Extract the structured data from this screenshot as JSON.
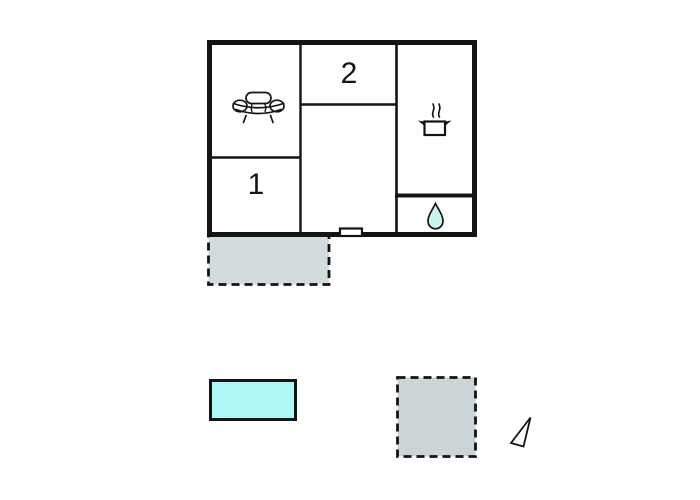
{
  "colors": {
    "ink": "#141414",
    "paper": "#ffffff",
    "terrace_fill": "#d3dbdc",
    "annex_fill": "#cbd4d6",
    "pool_fill": "#aef8f6",
    "drop_fill": "#c9f3ee"
  },
  "plan": {
    "room1_label": "1",
    "room2_label": "2",
    "icons": {
      "living_room": "sofa-icon",
      "kitchen": "cooking-pot-icon",
      "bathroom": "water-drop-icon",
      "compass": "north-arrow-icon"
    },
    "outdoor_areas": {
      "terrace_style": "dashed",
      "annex_style": "dashed",
      "pool_style": "solid"
    }
  }
}
